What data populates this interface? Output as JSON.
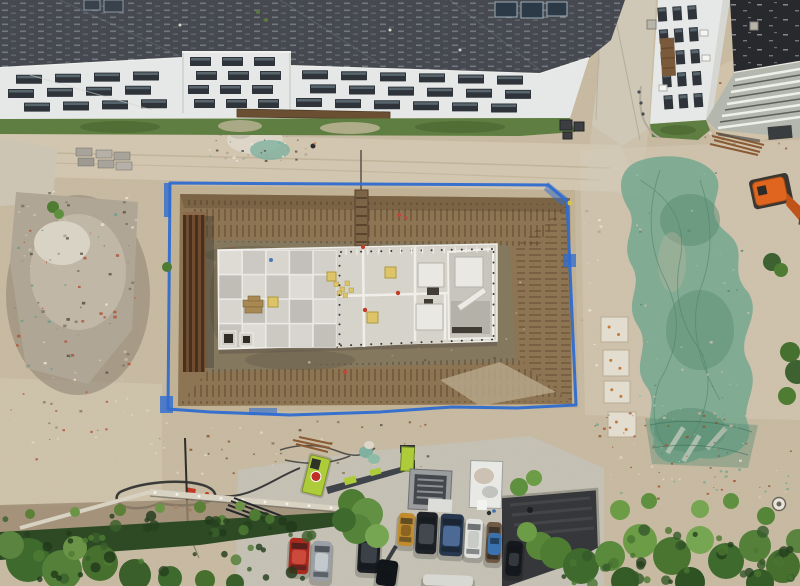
{
  "scene": {
    "type": "aerial-drone-photo",
    "subject": "construction-site-excavation-with-foundation-slab"
  },
  "palette": {
    "ground": "#c9bba2",
    "ground_light": "#dacfba",
    "ground_dark": "#b3a284",
    "road": "#c6c2b6",
    "concrete_path": "#cfc8b6",
    "pit_slope": "#8d7453",
    "pit_slope_dark": "#6e583c",
    "pit_floor": "#84785f",
    "pit_floor_dark": "#6d624e",
    "mud_dark": "#5f564a",
    "slab": "#d4d1c9",
    "slab_right": "#d6d3cb",
    "wall_white": "#efeee8",
    "tarp_blue": "#2f6cd0",
    "roof_dark": "#46494f",
    "membrane": "#27292d",
    "facade": "#e6e8e7",
    "window_dark": "#2e343a",
    "window_glint": "#8fa3b0",
    "grass": "#5f7f42",
    "grass_dark": "#46622f",
    "tree": "#4e7c33",
    "hedge": "#2e4a24",
    "netting": "#74a78e",
    "netting_dark": "#578b72",
    "crane_lime": "#aecb3a",
    "excavator_orange": "#e0661f",
    "brick_red": "#ad5338",
    "rebar_rust": "#8a5a33",
    "yellow_pad": "#ddc469"
  },
  "windows": {
    "sections": [
      {
        "x1": 8,
        "x2": 176,
        "w": 26,
        "gap": 13,
        "h": 9,
        "slope": -0.028,
        "rows": [
          {
            "y": 75,
            "off": 8
          },
          {
            "y": 89,
            "off": 0
          },
          {
            "y": 103,
            "off": 16
          }
        ]
      },
      {
        "x1": 186,
        "x2": 287,
        "w": 21,
        "gap": 11,
        "h": 9,
        "slope": 0,
        "rows": [
          {
            "y": 57,
            "off": 4
          },
          {
            "y": 71,
            "off": 10
          },
          {
            "y": 85,
            "off": 2
          },
          {
            "y": 99,
            "off": 8
          }
        ]
      },
      {
        "x1": 296,
        "x2": 555,
        "w": 26,
        "gap": 13,
        "h": 9,
        "slope": 0.028,
        "rows": [
          {
            "y": 70,
            "off": 6
          },
          {
            "y": 84,
            "off": 14
          },
          {
            "y": 98,
            "off": 0
          }
        ]
      }
    ],
    "right_building": {
      "cols": [
        661,
        676,
        691
      ],
      "w": 9,
      "rows": [
        6,
        28,
        50,
        72,
        94
      ],
      "h": 14,
      "rotate": "-4 685 60"
    }
  },
  "slab": {
    "checker": {
      "x": 219,
      "y": 250.5,
      "cols": 5,
      "rows": 4,
      "cw": 23.6,
      "ch": 24.5,
      "shades": [
        "#dedbd4",
        "#cbc9c2",
        "#d7d5ce",
        "#c2c0b9",
        "#d2d0c8",
        "#bfbdb6",
        "#dad8d1",
        "#c6c4bd"
      ]
    },
    "bolt_rows": [
      {
        "x1": 341,
        "y1": 252,
        "x2": 492,
        "y2": 249,
        "n": 16
      },
      {
        "x1": 341,
        "y1": 345.5,
        "x2": 492,
        "y2": 339.5,
        "n": 16
      },
      {
        "x1": 339.5,
        "y1": 256,
        "x2": 339.5,
        "y2": 344,
        "n": 10
      },
      {
        "x1": 493.5,
        "y1": 252,
        "x2": 493.5,
        "y2": 336,
        "n": 9
      }
    ],
    "tick_row": {
      "x1": 346,
      "y1": 249,
      "x2": 488,
      "y2": 246.5,
      "n": 14,
      "len": 6
    },
    "yellow_pads": [
      [
        385,
        267,
        11
      ],
      [
        367,
        312,
        11
      ],
      [
        327,
        272,
        9
      ],
      [
        268,
        297,
        10
      ]
    ],
    "yellow_cluster": [
      [
        334,
        282
      ],
      [
        340,
        287
      ],
      [
        345,
        281
      ],
      [
        337,
        291
      ],
      [
        343,
        293
      ],
      [
        349,
        288
      ]
    ]
  },
  "pads": [
    {
      "x": 601,
      "y": 317,
      "w": 27,
      "h": 25
    },
    {
      "x": 603,
      "y": 350,
      "w": 26,
      "h": 26
    },
    {
      "x": 604,
      "y": 381,
      "w": 26,
      "h": 22
    },
    {
      "x": 608,
      "y": 412,
      "w": 28,
      "h": 25
    }
  ],
  "vehicles": {
    "cars": [
      {
        "name": "red-car",
        "x": 289,
        "y": 538,
        "w": 20,
        "h": 36,
        "angle": 3,
        "body": "#ab2a1e",
        "roof": "#cc4a3c"
      },
      {
        "name": "silver-car",
        "x": 312,
        "y": 541,
        "w": 19,
        "h": 40,
        "angle": 3,
        "body": "#9aa0a5",
        "roof": "#c2c8cc"
      },
      {
        "name": "black-car",
        "x": 358,
        "y": 531,
        "w": 22,
        "h": 42,
        "angle": 3,
        "body": "#1a1d21",
        "roof": "#3c4148"
      },
      {
        "name": "dark-car-partial",
        "x": 377,
        "y": 560,
        "w": 20,
        "h": 26,
        "angle": 8,
        "body": "#111418",
        "roof": "#2c3136"
      },
      {
        "name": "yellow-loader",
        "x": 398,
        "y": 513,
        "w": 16,
        "h": 33,
        "angle": 4,
        "body": "#c18c2e",
        "roof": "#8a6420"
      },
      {
        "name": "black-suv",
        "x": 416,
        "y": 512,
        "w": 21,
        "h": 42,
        "angle": 3,
        "body": "#1e2227",
        "roof": "#43484e"
      },
      {
        "name": "navy-car",
        "x": 440,
        "y": 514,
        "w": 23,
        "h": 42,
        "angle": 3,
        "body": "#26374e",
        "roof": "#4d6a94"
      },
      {
        "name": "white-van",
        "x": 465,
        "y": 519,
        "w": 17,
        "h": 39,
        "angle": 3,
        "body": "#e2e3e0",
        "roof": "#c9cbc7"
      },
      {
        "name": "flatbed-truck",
        "x": 486,
        "y": 522,
        "w": 15,
        "h": 41,
        "angle": 3,
        "body": "#6e5a44",
        "roof": "#8a745a"
      },
      {
        "name": "blue-dumpster",
        "x": 488,
        "y": 533,
        "w": 13,
        "h": 22,
        "angle": 3,
        "body": "#3a72b0",
        "roof": "#5590cc"
      },
      {
        "name": "black-car-2",
        "x": 506,
        "y": 541,
        "w": 16,
        "h": 35,
        "angle": 4,
        "body": "#15181c",
        "roof": "#33383d"
      },
      {
        "name": "white-truck-partial",
        "x": 423,
        "y": 575,
        "w": 50,
        "h": 11,
        "angle": 2,
        "body": "#d8d8d3",
        "roof": "#b8b8b2"
      }
    ]
  },
  "trees": [
    {
      "cx": 352,
      "cy": 503,
      "r": 14,
      "c": "#4e7c33"
    },
    {
      "cx": 367,
      "cy": 514,
      "r": 16,
      "c": "#639143"
    },
    {
      "cx": 357,
      "cy": 529,
      "r": 15,
      "c": "#55833a"
    },
    {
      "cx": 377,
      "cy": 536,
      "r": 12,
      "c": "#77a653"
    },
    {
      "cx": 344,
      "cy": 520,
      "r": 12,
      "c": "#3f6a2e"
    },
    {
      "cx": 540,
      "cy": 546,
      "r": 14,
      "c": "#58873a"
    },
    {
      "cx": 527,
      "cy": 532,
      "r": 10,
      "c": "#6c9c46"
    },
    {
      "cx": 519,
      "cy": 487,
      "r": 9,
      "c": "#5f9040"
    },
    {
      "cx": 534,
      "cy": 478,
      "r": 8,
      "c": "#6c9c46"
    },
    {
      "cx": 556,
      "cy": 553,
      "r": 16,
      "c": "#4e7c33"
    },
    {
      "cx": 581,
      "cy": 566,
      "r": 18,
      "c": "#3f6a2e"
    },
    {
      "cx": 610,
      "cy": 556,
      "r": 15,
      "c": "#5a8a3c"
    },
    {
      "cx": 640,
      "cy": 541,
      "r": 17,
      "c": "#6c9c46"
    },
    {
      "cx": 672,
      "cy": 556,
      "r": 19,
      "c": "#4a7531"
    },
    {
      "cx": 700,
      "cy": 540,
      "r": 14,
      "c": "#77a653"
    },
    {
      "cx": 726,
      "cy": 561,
      "r": 18,
      "c": "#3f6a2e"
    },
    {
      "cx": 755,
      "cy": 546,
      "r": 16,
      "c": "#54803a"
    },
    {
      "cx": 783,
      "cy": 566,
      "r": 17,
      "c": "#47702f"
    },
    {
      "cx": 798,
      "cy": 541,
      "r": 12,
      "c": "#5a8440"
    },
    {
      "cx": 625,
      "cy": 581,
      "r": 14,
      "c": "#355c26"
    },
    {
      "cx": 690,
      "cy": 582,
      "r": 15,
      "c": "#2f5222"
    },
    {
      "cx": 760,
      "cy": 583,
      "r": 14,
      "c": "#355c26"
    },
    {
      "cx": 620,
      "cy": 510,
      "r": 10,
      "c": "#6c9c46"
    },
    {
      "cx": 649,
      "cy": 501,
      "r": 8,
      "c": "#5f9040"
    },
    {
      "cx": 700,
      "cy": 509,
      "r": 9,
      "c": "#77a653"
    },
    {
      "cx": 731,
      "cy": 501,
      "r": 8,
      "c": "#5f9040"
    },
    {
      "cx": 766,
      "cy": 516,
      "r": 9,
      "c": "#558539"
    },
    {
      "cx": 28,
      "cy": 560,
      "r": 22,
      "c": "#3f6a2e"
    },
    {
      "cx": 62,
      "cy": 570,
      "r": 20,
      "c": "#54803a"
    },
    {
      "cx": 100,
      "cy": 563,
      "r": 18,
      "c": "#47702f"
    },
    {
      "cx": 10,
      "cy": 545,
      "r": 14,
      "c": "#5a8440"
    },
    {
      "cx": 135,
      "cy": 575,
      "r": 16,
      "c": "#3a5f2a"
    },
    {
      "cx": 75,
      "cy": 548,
      "r": 12,
      "c": "#6c9447"
    },
    {
      "cx": 170,
      "cy": 578,
      "r": 12,
      "c": "#3f6a2e"
    },
    {
      "cx": 205,
      "cy": 580,
      "r": 10,
      "c": "#47702f"
    },
    {
      "cx": 235,
      "cy": 583,
      "r": 9,
      "c": "#3a5f2a"
    },
    {
      "cx": 772,
      "cy": 262,
      "r": 9,
      "c": "#3d6130"
    },
    {
      "cx": 781,
      "cy": 270,
      "r": 7,
      "c": "#4e7c33"
    },
    {
      "cx": 790,
      "cy": 352,
      "r": 10,
      "c": "#46702f"
    },
    {
      "cx": 797,
      "cy": 372,
      "r": 12,
      "c": "#3d6130"
    },
    {
      "cx": 787,
      "cy": 396,
      "r": 9,
      "c": "#4e7c33"
    },
    {
      "cx": 53,
      "cy": 207,
      "r": 6,
      "c": "#4e7c33"
    },
    {
      "cx": 59,
      "cy": 214,
      "r": 5,
      "c": "#5f9040"
    },
    {
      "cx": 167,
      "cy": 267,
      "r": 5,
      "c": "#4e7c33"
    },
    {
      "cx": 30,
      "cy": 514,
      "r": 5,
      "c": "#5c8038"
    },
    {
      "cx": 75,
      "cy": 512,
      "r": 5,
      "c": "#6c9447"
    },
    {
      "cx": 120,
      "cy": 510,
      "r": 6,
      "c": "#5c8038"
    },
    {
      "cx": 160,
      "cy": 508,
      "r": 5,
      "c": "#6c9447"
    },
    {
      "cx": 200,
      "cy": 507,
      "r": 6,
      "c": "#5c8038"
    },
    {
      "cx": 240,
      "cy": 506,
      "r": 5,
      "c": "#6c9447"
    },
    {
      "cx": 255,
      "cy": 515,
      "r": 6,
      "c": "#4e7c33"
    },
    {
      "cx": 222,
      "cy": 520,
      "r": 5,
      "c": "#55833a"
    }
  ],
  "speckles": [
    {
      "into": "spk-rubble",
      "x": 14,
      "y": 190,
      "w": 124,
      "h": 190,
      "n": 95,
      "s": [
        1,
        3.5
      ],
      "shape": "rect",
      "colors": [
        "#e8e2d4",
        "#7d7568",
        "#a89d8a",
        "#6f9e8c",
        "#b05538",
        "#59534a",
        "#c9c0ae"
      ]
    },
    {
      "into": "spk-floor",
      "x": 215,
      "y": 246,
      "w": 320,
      "h": 116,
      "n": 55,
      "s": [
        1,
        2.5
      ],
      "shape": "rect",
      "colors": [
        "#c9bfa9",
        "#5f564a",
        "#a39781",
        "#b05538"
      ]
    },
    {
      "into": "spk-brick",
      "x": 588,
      "y": 412,
      "w": 205,
      "h": 86,
      "n": 95,
      "s": [
        1,
        3
      ],
      "shape": "rect",
      "colors": [
        "#ad5338",
        "#c8b49a",
        "#8a5a33",
        "#ddd6c6",
        "#74a78e"
      ]
    },
    {
      "into": "spk-top",
      "x": 205,
      "y": 124,
      "w": 110,
      "h": 38,
      "n": 40,
      "s": [
        1,
        3
      ],
      "shape": "rect",
      "colors": [
        "#e8e2d4",
        "#7fb0a0",
        "#b0a793",
        "#59534a"
      ]
    },
    {
      "into": "spk-bottom",
      "x": 150,
      "y": 420,
      "w": 280,
      "h": 58,
      "n": 48,
      "s": [
        1,
        3
      ],
      "shape": "rect",
      "colors": [
        "#8a7c64",
        "#ddd6c6",
        "#59534a",
        "#8a5a33"
      ]
    },
    {
      "into": "spk-hedge",
      "x": 0,
      "y": 515,
      "w": 345,
      "h": 66,
      "n": 55,
      "s": [
        2,
        6
      ],
      "shape": "circle",
      "colors": [
        "#24401d",
        "#3a5f2a",
        "#4e7c33",
        "#203a1a"
      ]
    },
    {
      "into": "spk-hedge",
      "x": 555,
      "y": 530,
      "w": 245,
      "h": 54,
      "n": 42,
      "s": [
        2,
        6
      ],
      "shape": "circle",
      "colors": [
        "#24401d",
        "#35592a",
        "#4a7531"
      ]
    },
    {
      "into": "spk-white",
      "x": 580,
      "y": 210,
      "w": 22,
      "h": 180,
      "n": 26,
      "s": [
        1,
        3
      ],
      "shape": "rect",
      "colors": [
        "#e8e2d4",
        "#b0a793",
        "#c9c0ae"
      ]
    },
    {
      "into": "spk-net",
      "x": 630,
      "y": 170,
      "w": 120,
      "h": 280,
      "n": 48,
      "s": [
        1,
        3
      ],
      "shape": "rect",
      "colors": [
        "#578b72",
        "#8fbca6",
        "#c8bfae"
      ]
    },
    {
      "into": "spk-mound",
      "x": 700,
      "y": 70,
      "w": 90,
      "h": 80,
      "n": 30,
      "s": [
        1,
        3
      ],
      "shape": "rect",
      "colors": [
        "#8a5a33",
        "#e0d8c6",
        "#9a8a6a"
      ]
    },
    {
      "into": "spk-misc",
      "x": 10,
      "y": 390,
      "w": 150,
      "h": 70,
      "n": 28,
      "s": [
        1,
        3
      ],
      "shape": "rect",
      "colors": [
        "#ddd6c6",
        "#b05538",
        "#8a7c64"
      ]
    }
  ]
}
